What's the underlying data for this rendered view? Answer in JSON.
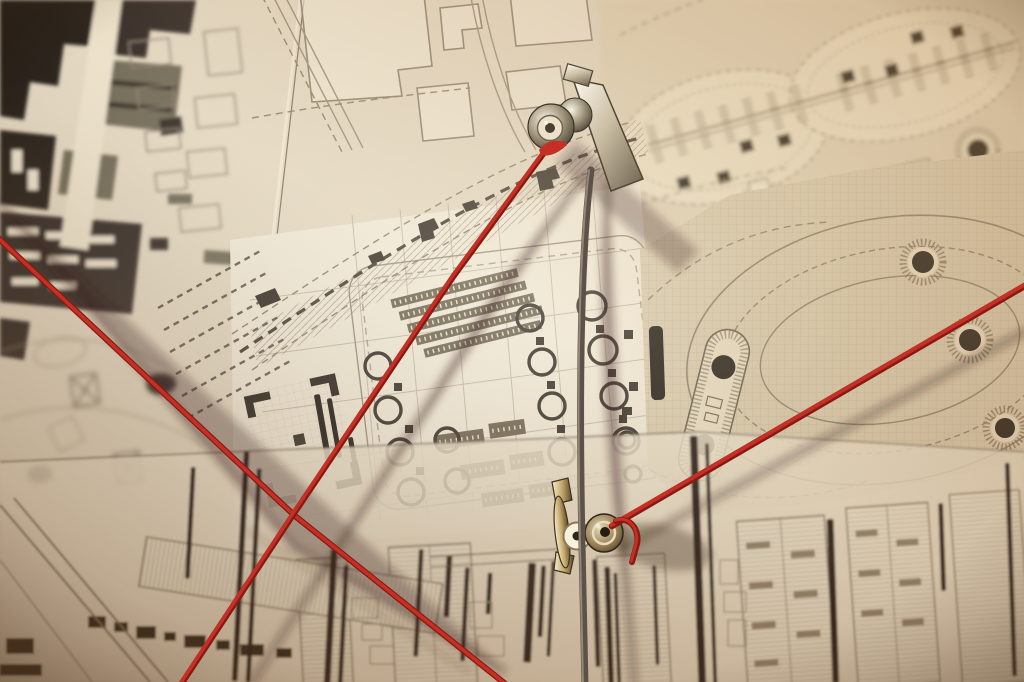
{
  "image": {
    "kind": "photograph",
    "subject": "Architectural site plan pinned to a wall with two metal clips, red yarn threads and a hanging dark cord",
    "width_px": 1024,
    "height_px": 682
  },
  "colors": {
    "paper": "#e5dac4",
    "paper_bright": "#f4edda",
    "sepia_corner": "#c09a6e",
    "ink": "#17130e",
    "ink_soft": "#4a4336",
    "map_line": "#8d8170",
    "red_yarn": "#c53026",
    "red_yarn_deep": "#871a12",
    "cord": "#5d5249",
    "cord_light": "#a29384",
    "metal_bright": "#faf4e4",
    "metal_dark": "#3f3829",
    "brass": "#c4a76a"
  },
  "threads": {
    "red_left_diagonal": {
      "label": "red yarn from left edge crossing to bottom center",
      "d": "M -4,236 L 295,516 L 508,686"
    },
    "red_top_clip": {
      "label": "red yarn from top clip to bottom left",
      "d": "M 549,146 L 453,277 L 293,515 L 180,686"
    },
    "red_bottom_clip": {
      "label": "red yarn from bottom clip to right edge",
      "d": "M 612,526 L 1028,284"
    },
    "red_tail": {
      "label": "short red yarn tail below bottom clip",
      "d": "M 616,521 C 630,516 640,530 637,544 L 632,562"
    },
    "red_knot": {
      "label": "red yarn knot at top clip",
      "d": "M 539,150 Q 547,139 560,141 Q 568,142 567,145 Q 553,158 541,155 Z"
    },
    "dark_cord": {
      "label": "dark cord hanging vertically through bottom clip",
      "d": "M 591,170 C 580,260 579,400 582,545 C 583,610 584,650 585,686"
    }
  },
  "clips": {
    "top": {
      "label": "metal bulldog clip pinning map (top)",
      "transform": "translate(551,127)"
    },
    "bottom": {
      "label": "metal clip pinning map (bottom, side view)",
      "transform": "translate(590,530)"
    }
  }
}
